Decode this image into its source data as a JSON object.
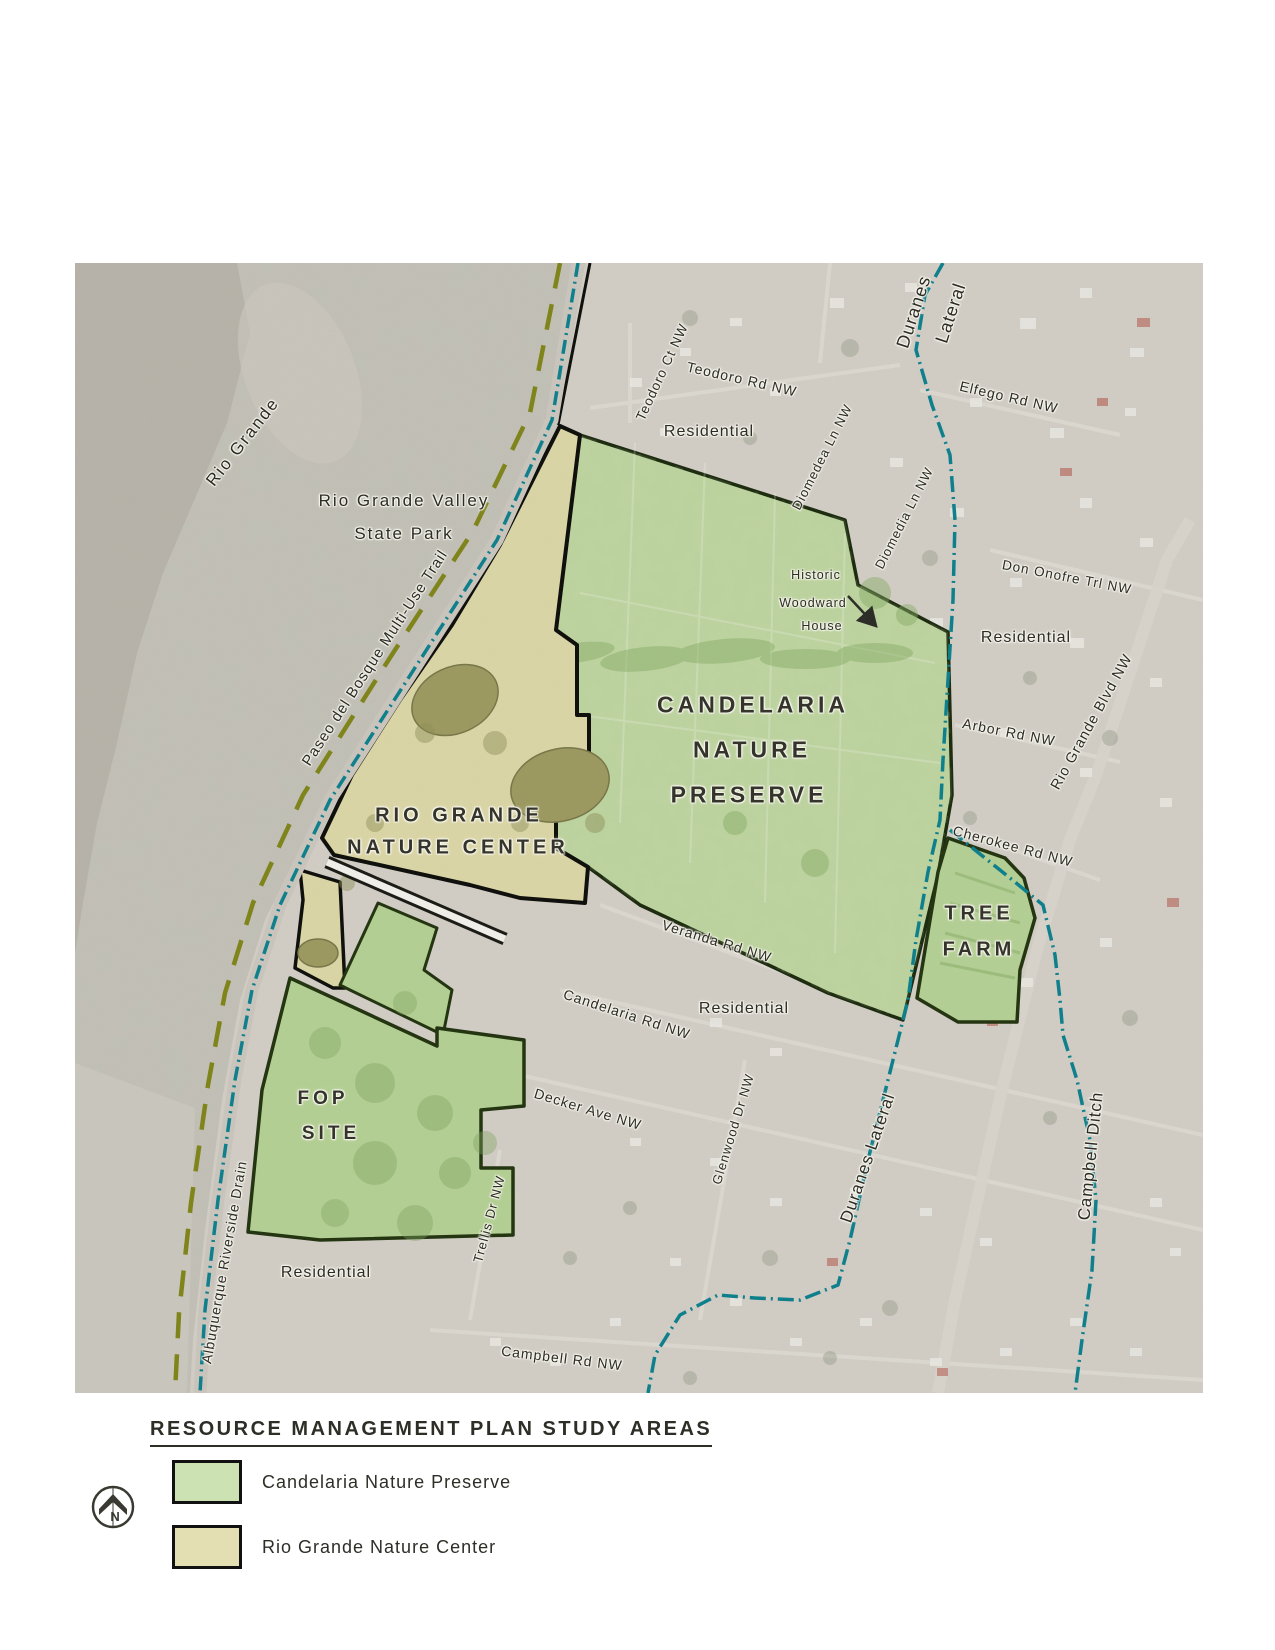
{
  "map": {
    "labels": [
      {
        "id": "rio-grande",
        "text": "Rio Grande"
      },
      {
        "id": "state-park-line1",
        "text": "Rio Grande Valley"
      },
      {
        "id": "state-park-line2",
        "text": "State Park"
      },
      {
        "id": "paseo-trail",
        "text": "Paseo del Bosque Multi-Use Trail"
      },
      {
        "id": "riverside-drain",
        "text": "Albuquerque Riverside Drain"
      },
      {
        "id": "teodoro-ct",
        "text": "Teodoro Ct NW"
      },
      {
        "id": "teodoro-rd",
        "text": "Teodoro Rd NW"
      },
      {
        "id": "residential-north",
        "text": "Residential"
      },
      {
        "id": "duranes-word1",
        "text": "Duranes"
      },
      {
        "id": "duranes-word2",
        "text": "Lateral"
      },
      {
        "id": "elfego-rd",
        "text": "Elfego Rd NW"
      },
      {
        "id": "diomedea-ln",
        "text": "Diomedea Ln NW"
      },
      {
        "id": "diomedia-ln",
        "text": "Diomedia Ln NW"
      },
      {
        "id": "don-onofre",
        "text": "Don Onofre Trl NW"
      },
      {
        "id": "residential-east",
        "text": "Residential"
      },
      {
        "id": "arbor-rd",
        "text": "Arbor Rd NW"
      },
      {
        "id": "rio-grande-blvd",
        "text": "Rio Grande Blvd NW"
      },
      {
        "id": "cherokee-rd",
        "text": "Cherokee Rd NW"
      },
      {
        "id": "historic-line1",
        "text": "Historic"
      },
      {
        "id": "historic-line2",
        "text": "Woodward"
      },
      {
        "id": "historic-line3",
        "text": "House"
      },
      {
        "id": "preserve-line1",
        "text": "CANDELARIA"
      },
      {
        "id": "preserve-line2",
        "text": "NATURE"
      },
      {
        "id": "preserve-line3",
        "text": "PRESERVE"
      },
      {
        "id": "nature-center-line1",
        "text": "RIO GRANDE"
      },
      {
        "id": "nature-center-line2",
        "text": "NATURE CENTER"
      },
      {
        "id": "tree-farm-line1",
        "text": "TREE"
      },
      {
        "id": "tree-farm-line2",
        "text": "FARM"
      },
      {
        "id": "veranda-rd",
        "text": "Veranda Rd NW"
      },
      {
        "id": "residential-mid",
        "text": "Residential"
      },
      {
        "id": "candelaria-rd",
        "text": "Candelaria Rd NW"
      },
      {
        "id": "decker-ave",
        "text": "Decker Ave NW"
      },
      {
        "id": "glenwood-dr",
        "text": "Glenwood Dr NW"
      },
      {
        "id": "duranes-lateral",
        "text": "Duranes Lateral"
      },
      {
        "id": "campbell-ditch",
        "text": "Campbell Ditch"
      },
      {
        "id": "trellis-dr",
        "text": "Trellis Dr NW"
      },
      {
        "id": "residential-south",
        "text": "Residential"
      },
      {
        "id": "fop-line1",
        "text": "FOP"
      },
      {
        "id": "fop-line2",
        "text": "SITE"
      },
      {
        "id": "campbell-rd",
        "text": "Campbell Rd NW"
      }
    ],
    "feature_colors": {
      "preserve_fill": "#bdd49f",
      "nature_center_fill": "#dbd6a6",
      "study_green_fill": "#b4d094",
      "waterway_teal": "#0c7f8c",
      "trail_olive": "#7f8418",
      "boundary_black": "#0d0d0a",
      "boundary_dark_green": "#22330f"
    }
  },
  "legend": {
    "title": "RESOURCE MANAGEMENT PLAN STUDY AREAS",
    "items": [
      {
        "label": "Candelaria Nature Preserve",
        "color": "#cde2b2"
      },
      {
        "label": "Rio Grande Nature Center",
        "color": "#e4dfb2"
      }
    ]
  },
  "compass": {
    "north_label": "N"
  }
}
